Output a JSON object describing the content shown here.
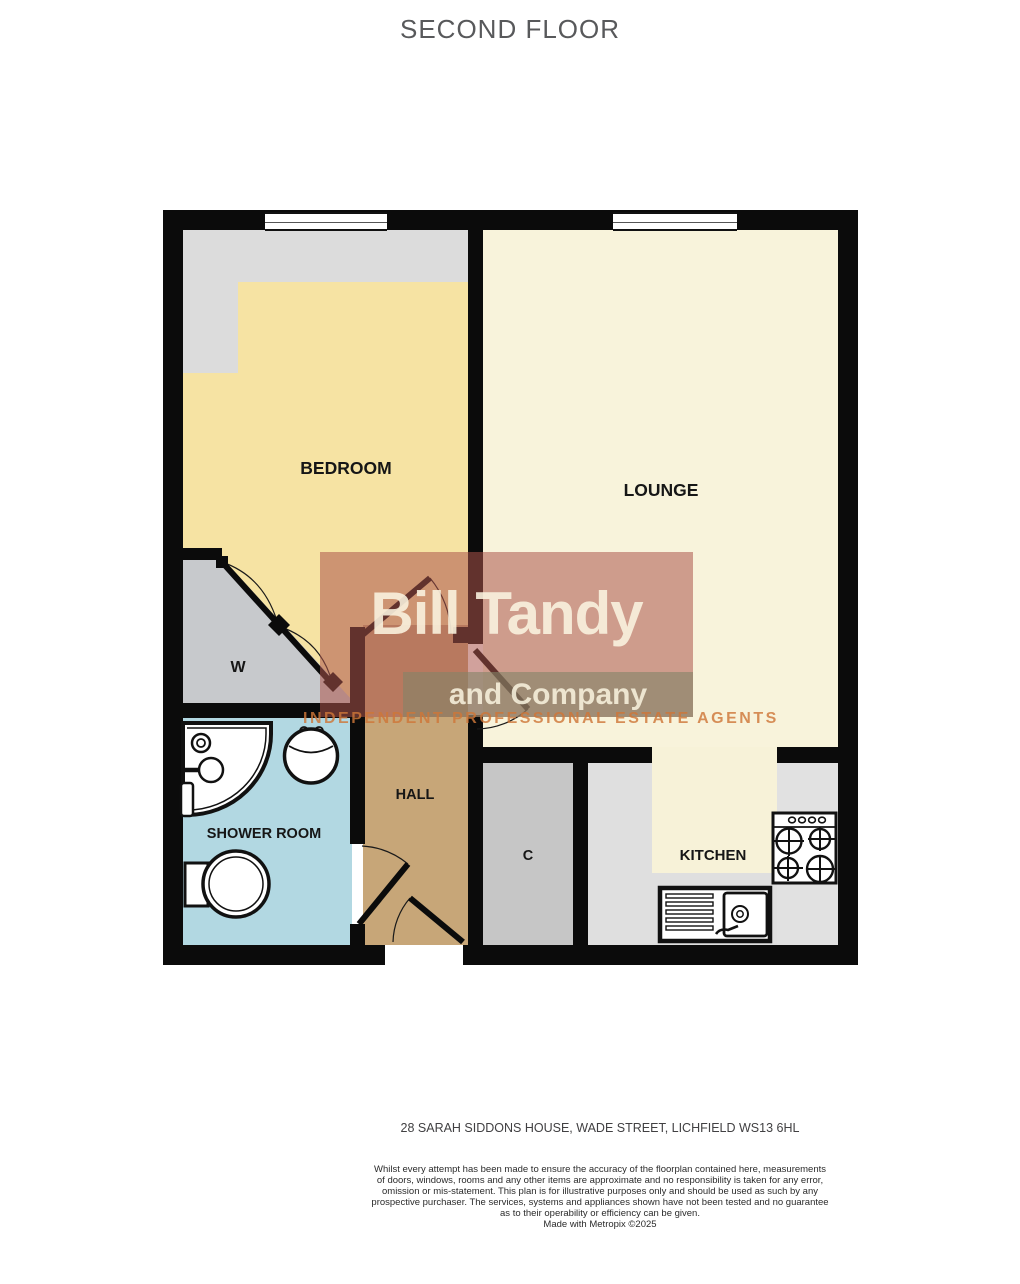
{
  "title": "SECOND FLOOR",
  "floorplan": {
    "rooms": {
      "bedroom": {
        "label": "BEDROOM"
      },
      "lounge": {
        "label": "LOUNGE"
      },
      "wardrobe": {
        "label": "W"
      },
      "shower": {
        "label": "SHOWER ROOM"
      },
      "hall": {
        "label": "HALL"
      },
      "cupboard": {
        "label": "C"
      },
      "kitchen": {
        "label": "KITCHEN"
      }
    },
    "fixtures": [
      "corner-shower",
      "wash-basin",
      "toilet",
      "sink-and-drainer",
      "gas-hob",
      "bifold-wardrobe-door"
    ],
    "colors": {
      "wall": "#0b0b0b",
      "bedroom_floor": "#F6E3A3",
      "bedroom_recess": "#DCDCDC",
      "lounge_floor": "#F8F3DB",
      "wardrobe_floor": "#C7C9CC",
      "shower_floor": "#B2D8E2",
      "hall_floor": "#C7A678",
      "cupboard_floor": "#C6C6C6",
      "kitchen_floor": "#F7F2D8",
      "kitchen_worktop": "#DFDFDF"
    }
  },
  "watermark": {
    "name": "Bill Tandy",
    "company": "and Company",
    "tagline": "INDEPENDENT PROFESSIONAL ESTATE AGENTS",
    "accent_red": "#AC544A",
    "accent_olive": "#828368"
  },
  "footer": {
    "address": "28 SARAH SIDDONS HOUSE, WADE STREET, LICHFIELD WS13 6HL",
    "disclaimer": {
      "lines": [
        "Whilst every attempt has been made to ensure the accuracy of the floorplan contained here, measurements",
        "of doors, windows, rooms and any other items are approximate and no responsibility is taken for any error,",
        "omission or mis-statement. This plan is for illustrative purposes only and should be used as such by any",
        "prospective purchaser. The services, systems and appliances shown have not been tested and no guarantee",
        "as to their operability or efficiency can be given.",
        "Made with Metropix ©2025"
      ]
    }
  }
}
